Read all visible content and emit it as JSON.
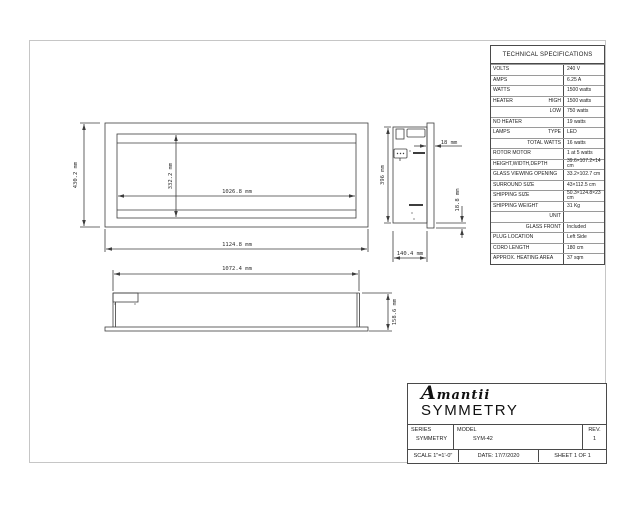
{
  "spec_table": {
    "title": "TECHNICAL SPECIFICATIONS",
    "rows": [
      {
        "label": "VOLTS",
        "sublabel": "",
        "value": "240 V"
      },
      {
        "label": "AMPS",
        "sublabel": "",
        "value": "6.25 A"
      },
      {
        "label": "WATTS",
        "sublabel": "",
        "value": "1500 watts"
      },
      {
        "label": "HEATER",
        "sublabel": "HIGH",
        "value": "1500 watts"
      },
      {
        "label": "",
        "sublabel": "LOW",
        "value": "750 watts"
      },
      {
        "label": "NO HEATER",
        "sublabel": "",
        "value": "19 watts"
      },
      {
        "label": "LAMPS",
        "sublabel": "TYPE",
        "value": "LED"
      },
      {
        "label": "",
        "sublabel": "TOTAL WATTS",
        "value": "16 watts"
      },
      {
        "label": "ROTOR MOTOR",
        "sublabel": "",
        "value": "1 at 5 watts"
      },
      {
        "label": "HEIGHT,WIDTH,DEPTH",
        "sublabel": "",
        "value": "39.6×107.2×14 cm"
      },
      {
        "label": "GLASS VIEWING OPENING",
        "sublabel": "",
        "value": "33.2×102.7 cm"
      },
      {
        "label": "SURROUND SIZE",
        "sublabel": "",
        "value": "43×112.5 cm"
      },
      {
        "label": "SHIPPING SIZE",
        "sublabel": "",
        "value": "50.3×124.8×23 cm"
      },
      {
        "label": "SHIPPING WEIGHT",
        "sublabel": "",
        "value": "31 Kg"
      },
      {
        "label": "",
        "sublabel": "UNIT",
        "value": ""
      },
      {
        "label": "",
        "sublabel": "GLASS FRONT",
        "value": "Included"
      },
      {
        "label": "PLUG LOCATION",
        "sublabel": "",
        "value": "Left Side"
      },
      {
        "label": "CORD LENGTH",
        "sublabel": "",
        "value": "180 cm"
      },
      {
        "label": "APPROX. HEATING AREA",
        "sublabel": "",
        "value": "37 sqm"
      }
    ]
  },
  "title_block": {
    "logo_text": "Amantii",
    "product_title": "SYMMETRY",
    "series_label": "SERIES",
    "series_value": "SYMMETRY",
    "model_label": "MODEL",
    "model_value": "SYM-42",
    "rev_label": "REV.",
    "rev_value": "1",
    "scale_text": "SCALE 1\"=1'-0\"",
    "date_text": "DATE: 17/7/2020",
    "sheet_text": "SHEET 1 OF 1"
  },
  "dimensions": {
    "front_height": "430.2 mm",
    "glass_height": "332.2 mm",
    "glass_width": "1026.8 mm",
    "front_width": "1124.8 mm",
    "side_height": "396 mm",
    "flange_depth": "18 mm",
    "flange_offset": "18.8 mm",
    "side_depth": "140.4 mm",
    "top_width": "1072.4 mm",
    "top_depth": "158.6 mm"
  },
  "colors": {
    "line": "#3d3d3d",
    "frame": "#c6c6c6",
    "table_border": "#4a4a4a"
  }
}
